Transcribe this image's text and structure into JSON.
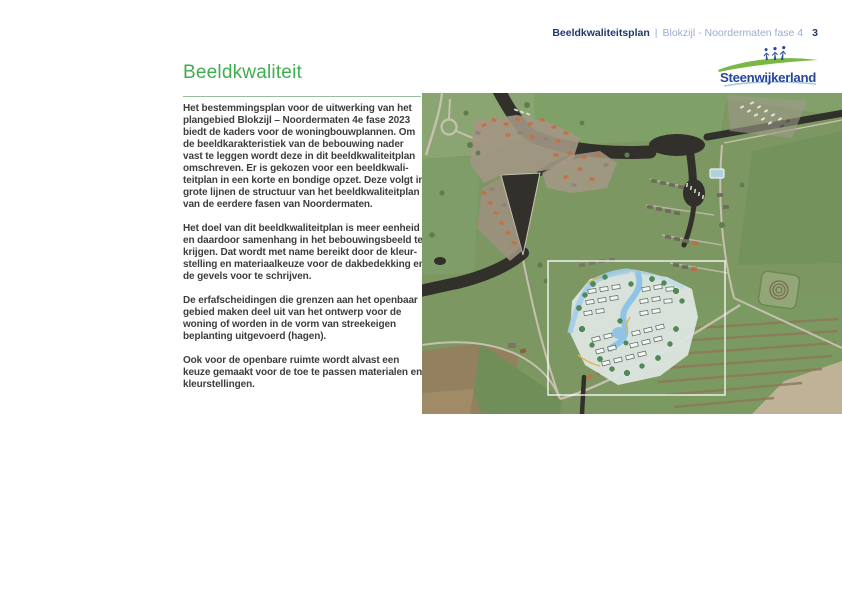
{
  "header": {
    "title": "Beeldkwaliteitsplan",
    "separator": "|",
    "subtitle": "Blokzijl - Noordermaten fase 4",
    "page_number": "3"
  },
  "logo": {
    "name": "Steenwijkerland",
    "text_color": "#27479e",
    "swoosh_color": "#79b843",
    "figure_color": "#27479e"
  },
  "main": {
    "title": "Beeldkwaliteit",
    "title_color": "#3fae4e",
    "paragraphs": [
      "Het bestemmingsplan voor de uitwerking van het\nplangebied Blokzijl – Noordermaten 4e fase 2023\nbiedt de kaders voor de woningbouwplannen. Om\nde beeldkarakteristiek van de bebouwing nader\nvast te leggen wordt deze in dit beeldkwaliteitplan\nomschreven. Er is gekozen voor een beeldkwali-\nteitplan in een korte en bondige opzet. Deze volgt in\ngrote lijnen de structuur van het beeldkwaliteitplan\nvan de eerdere fasen van Noordermaten.",
      "Het doel van dit beeldkwaliteitplan is meer eenheid\nen daardoor samenhang in het bebouwingsbeeld te\nkrijgen. Dat wordt met name bereikt door de kleur-\nstelling en materiaalkeuze voor de dakbedekking en\nde gevels voor te schrijven.",
      "De erfafscheidingen die grenzen aan het openbaar\ngebied maken deel uit van het ontwerp voor de\nwoning of worden in de vorm van streekeigen\nbeplanting uitgevoerd (hagen).",
      "Ook voor de openbare ruimte wordt alvast een\nkeuze gemaakt voor de toe te passen materialen en\nkleurstellingen."
    ]
  },
  "map": {
    "colors": {
      "field_green": "#7d9762",
      "water_dark": "#31302b",
      "roof_orange": "#c17347",
      "plan_fill": "#dde6e2",
      "plan_water": "#8fc4e6",
      "boundary_white": "#ffffff"
    }
  }
}
